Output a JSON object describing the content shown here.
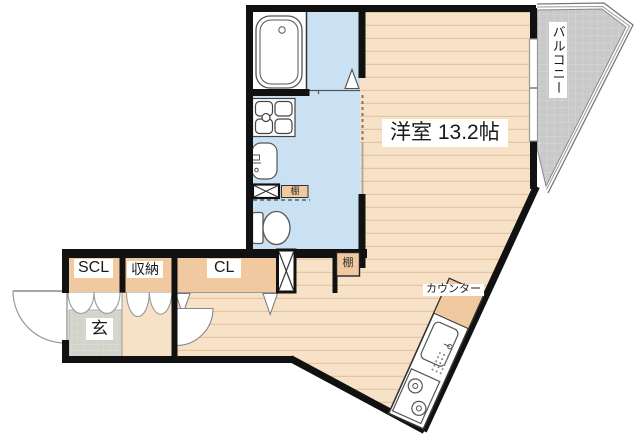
{
  "labels": {
    "main_room": "洋室 13.2帖",
    "balcony": "バルコニー",
    "entrance": "玄",
    "shoe_closet": "SCL",
    "storage": "収納",
    "closet": "CL",
    "shelf_upper": "棚",
    "shelf_lower": "棚",
    "counter": "カウンター"
  },
  "colors": {
    "wood_floor": "#f7e2c8",
    "wood_line": "#e5c6a2",
    "wet_area": "#c9e1f3",
    "closet_band": "#f1c9a0",
    "balcony_fill": "#c9c9c9",
    "balcony_grid": "#d9d9d9",
    "entrance_tile": "#d3d3cb",
    "entrance_grid": "#dfded6",
    "wall": "#111111",
    "label_text": "#1a1a1a"
  }
}
